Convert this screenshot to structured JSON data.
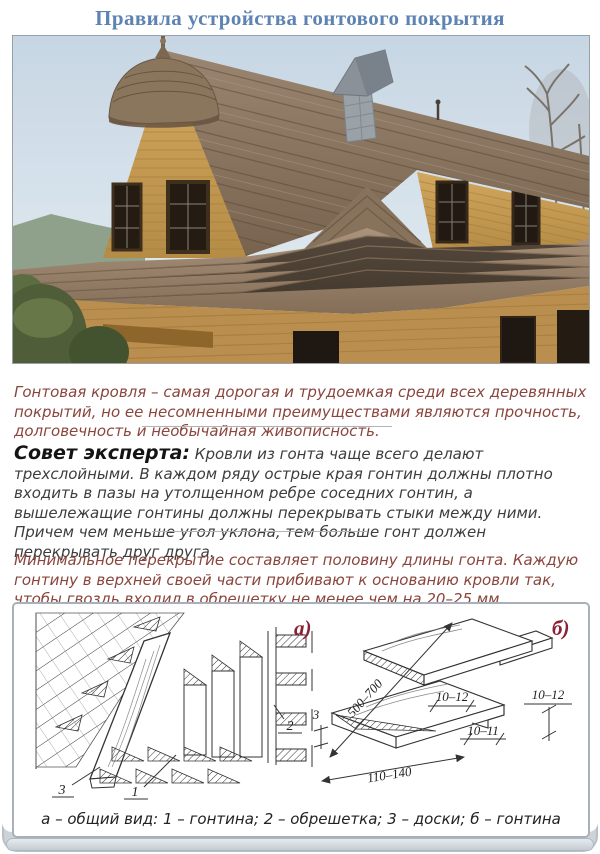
{
  "header": {
    "title": "Правила устройства гонтового покрытия"
  },
  "sections": {
    "intro": {
      "text": "Гонтовая кровля – самая дорогая и трудоемкая среди всех деревянных покрытий, но ее несомненными преимуществами являются прочность, долговечность и необычайная живописность."
    },
    "expert": {
      "label": "Совет эксперта:",
      "text": "Кровли из гонта чаще всего делают трехслойными. В каждом ряду острые края гонтин должны плотно входить в пазы на утолщенном ребре соседних гонтин, а вышележащие гонтины должны перекрывать стыки между ними. Причем чем меньше угол уклона, тем больше гонт должен перекрывать друг друга."
    },
    "overlap": {
      "text": "Минимальное перекрытие составляет половину длины гонта. Каждую гонтину в верхней своей части прибивают к основанию кровли так, чтобы гвоздь входил в обрешетку не менее чем на 20–25 мм."
    }
  },
  "figure": {
    "label_a": "а)",
    "label_b": "б)",
    "callouts": {
      "c1": "1",
      "c2": "2",
      "c3": "3"
    },
    "dims": {
      "length": "500–700",
      "edge": "3",
      "top_gap": "10–12",
      "right_gap": "10–12",
      "tongue": "10–11",
      "width": "110–140"
    },
    "caption": "а – общий вид: 1 – гонтина; 2 – обрешетка; 3 – доски; б – гонтина"
  },
  "colors": {
    "title_blue": "#5d83b3",
    "accent_red": "#8b2134",
    "body_maroon": "#8a453c"
  }
}
